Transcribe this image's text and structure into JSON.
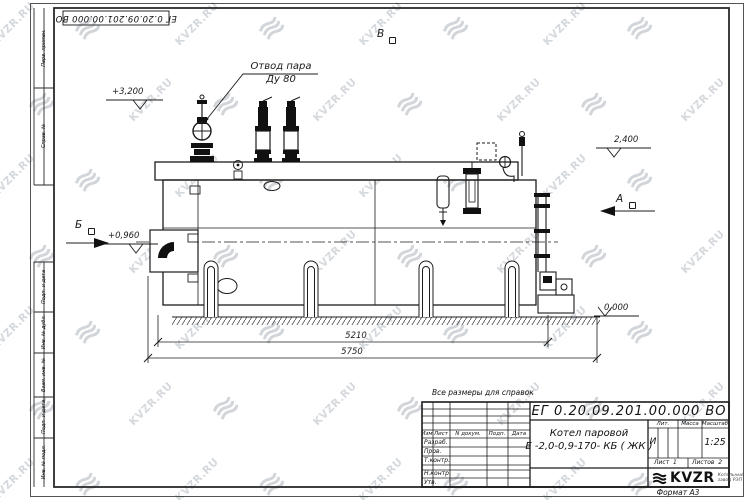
{
  "watermark": {
    "text": "KVZR.RU",
    "text_color": "#bcc2c9",
    "icon_color": "#aeb5bd"
  },
  "frame": {
    "stamp_top": "ЕГ 0.20.09.201.00.000  ВО",
    "format_note": "Формат А3",
    "side_labels_upper": [
      "Перв. примен.",
      "Справ. №"
    ],
    "side_labels_lower": [
      "Подп. и дата",
      "Инв. № дубл.",
      "Взам. инв. №",
      "Подп. и дата",
      "Инв. № подл."
    ]
  },
  "drawing": {
    "labels": {
      "steam_outlet_line1": "Отвод пара",
      "steam_outlet_line2": "Ду 80",
      "view_v_top": "В",
      "view_a": "А",
      "view_b_left": "Б",
      "elev_3200": "+3,200",
      "elev_2400": "2,400",
      "elev_0960": "+0,960",
      "elev_0000": "0,000",
      "dim_5210": "5210",
      "dim_5750": "5750"
    }
  },
  "title_block": {
    "note": "Все размеры для справок",
    "doc_number": "ЕГ 0.20.09.201.00.000  ВО",
    "product_name_line1": "Котел паровой",
    "product_name_line2": "Е -2,0-0,9-170- КБ ( ЖК )",
    "header_row": {
      "izm": "Изм",
      "list": "Лист",
      "ndoc": "N докум.",
      "podp": "Подп.",
      "data": "Дата"
    },
    "roles": [
      "Разраб.",
      "Пров.",
      "Т.контр.",
      "Н.контр.",
      "Утв."
    ],
    "lit_header": "Лит.",
    "mass_header": "Масса",
    "scale_header": "Масштаб",
    "lit_value": "И",
    "scale_value": "1:25",
    "sheet_label": "Лист",
    "sheet_value": "1",
    "sheets_label": "Листов",
    "sheets_value": "2",
    "logo_text": "KVZR",
    "logo_caption_line1": "Котельный",
    "logo_caption_line2": "завод РЭП"
  }
}
